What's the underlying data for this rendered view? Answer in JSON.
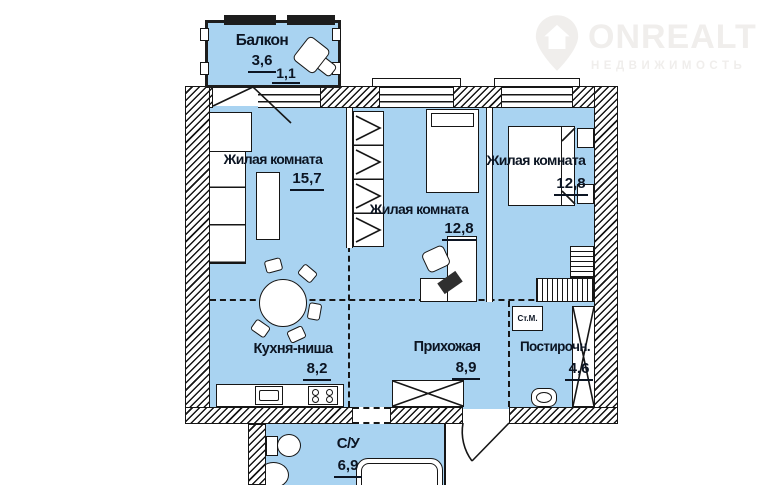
{
  "logo": {
    "brand": "ONREALT",
    "subtitle": "НЕДВИЖИМОСТЬ"
  },
  "colors": {
    "fill": "#a9d3f1",
    "line": "#161616",
    "txt": "#0c1523",
    "logo": "#f0eeec"
  },
  "rooms": {
    "balcony": {
      "label": "Балкон",
      "area": "3,6",
      "area2": "1,1"
    },
    "living1": {
      "label": "Жилая комната",
      "area": "15,7"
    },
    "living2": {
      "label": "Жилая комната",
      "area": "12,8"
    },
    "living3": {
      "label": "Жилая комната",
      "area": "12,8"
    },
    "kitchen": {
      "label": "Кухня-ниша",
      "area": "8,2"
    },
    "hallway": {
      "label": "Прихожая",
      "area": "8,9"
    },
    "laundry": {
      "label": "Постирочн.",
      "area": "4,6"
    },
    "bathroom": {
      "label": "С/У",
      "area": "6,9"
    }
  },
  "appliances": {
    "washing_machine": "Ст.М."
  }
}
